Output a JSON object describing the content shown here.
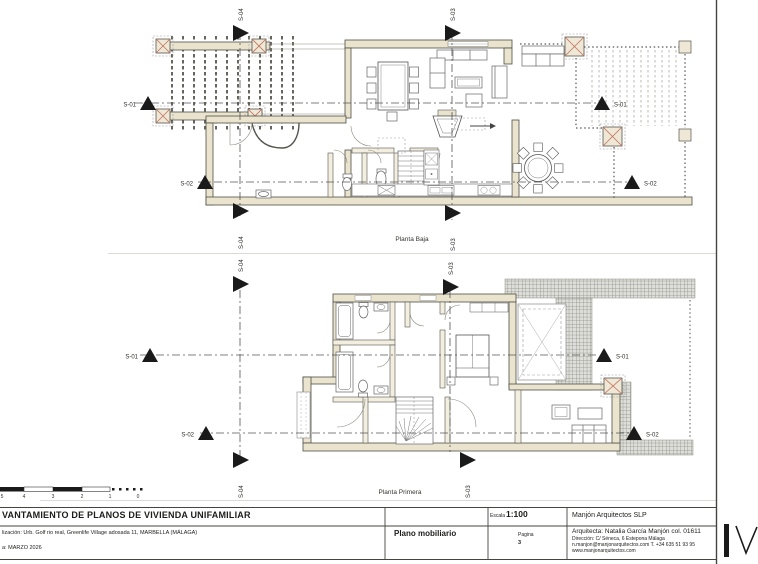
{
  "document": {
    "title_line": "VANTAMIENTO DE PLANOS DE VIVIENDA UNIFAMILIAR",
    "location_line": "lización:  Urb. Golf rio real, Greenlife Village adosada 11, MARBELLA (MÁLAGA)",
    "date_line": "a: MARZO 2026"
  },
  "title_block": {
    "scale_label": "Escala",
    "scale_value": "1:100",
    "firm": "Manjón Arquitectos SLP",
    "drawing_name": "Plano mobiliario",
    "page_label": "Pagina",
    "page_number": "3",
    "architect": "Arquitecta: Natalia García Manjón col. 01611",
    "address": "Dirección: C/ Séneca, 6 Estepona Málaga",
    "contact": "n.manjon@manjonarquitectos.com T. +34 635 51 93 95",
    "website": "www.manjonarquitectos.com"
  },
  "plans": {
    "ground_floor_label": "Planta Baja",
    "first_floor_label": "Planta Primera"
  },
  "sections": {
    "s01": "S-01",
    "s02": "S-02",
    "s03": "S-03",
    "s04": "S-04"
  },
  "scale_bar": {
    "ticks": [
      "5",
      "4",
      "3",
      "2",
      "1",
      "0"
    ]
  },
  "colors": {
    "wall_fill": "#eae4cf",
    "wall_line": "#4f4e47",
    "accent_red": "#c4705c",
    "roof_hatch": "#8a8a80",
    "marker_black": "#1a1a1a"
  }
}
